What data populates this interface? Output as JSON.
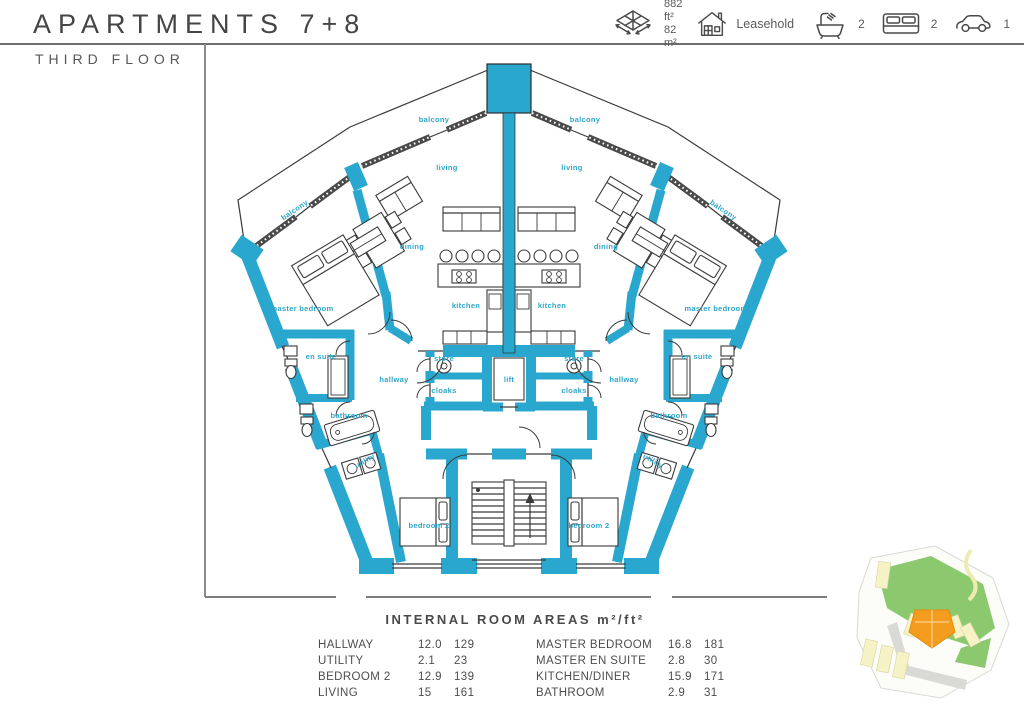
{
  "header": {
    "title": "APARTMENTS 7+8",
    "subtitle": "THIRD FLOOR",
    "stats": {
      "area_ft2": "882 ft²",
      "area_m2": "82 m²",
      "tenure": "Leasehold",
      "bathrooms": "2",
      "bedrooms": "2",
      "parking": "1",
      "icons": [
        "floor-area-icon",
        "house-icon",
        "bathtub-icon",
        "double-bed-icon",
        "car-icon"
      ]
    }
  },
  "plan": {
    "wall_color": "#2AA7CE",
    "label_color": "#2FA6C9",
    "room_labels": [
      {
        "text": "balcony",
        "x": 434,
        "y": 122,
        "rot": 0
      },
      {
        "text": "balcony",
        "x": 585,
        "y": 122,
        "rot": 0
      },
      {
        "text": "balcony",
        "x": 296,
        "y": 212,
        "rot": -34
      },
      {
        "text": "balcony",
        "x": 722,
        "y": 212,
        "rot": 34
      },
      {
        "text": "living",
        "x": 447,
        "y": 170,
        "rot": 0
      },
      {
        "text": "living",
        "x": 572,
        "y": 170,
        "rot": 0
      },
      {
        "text": "dining",
        "x": 412,
        "y": 249,
        "rot": 0
      },
      {
        "text": "dining",
        "x": 606,
        "y": 249,
        "rot": 0
      },
      {
        "text": "kitchen",
        "x": 466,
        "y": 308,
        "rot": 0
      },
      {
        "text": "kitchen",
        "x": 552,
        "y": 308,
        "rot": 0
      },
      {
        "text": "master bedroom",
        "x": 302,
        "y": 311,
        "rot": 0
      },
      {
        "text": "master bedroom",
        "x": 716,
        "y": 311,
        "rot": 0
      },
      {
        "text": "en suite",
        "x": 321,
        "y": 359,
        "rot": 0
      },
      {
        "text": "en suite",
        "x": 697,
        "y": 359,
        "rot": 0
      },
      {
        "text": "hallway",
        "x": 394,
        "y": 382,
        "rot": 0
      },
      {
        "text": "hallway",
        "x": 624,
        "y": 382,
        "rot": 0
      },
      {
        "text": "store",
        "x": 444,
        "y": 361,
        "rot": 0
      },
      {
        "text": "store",
        "x": 574,
        "y": 361,
        "rot": 0
      },
      {
        "text": "cloaks",
        "x": 444,
        "y": 393,
        "rot": 0
      },
      {
        "text": "cloaks",
        "x": 574,
        "y": 393,
        "rot": 0
      },
      {
        "text": "lift",
        "x": 509,
        "y": 382,
        "rot": 0
      },
      {
        "text": "bathroom",
        "x": 349,
        "y": 418,
        "rot": 0
      },
      {
        "text": "bathroom",
        "x": 669,
        "y": 418,
        "rot": 0
      },
      {
        "text": "utility",
        "x": 366,
        "y": 463,
        "rot": -30
      },
      {
        "text": "utility",
        "x": 652,
        "y": 463,
        "rot": 30
      },
      {
        "text": "bedroom 2",
        "x": 429,
        "y": 528,
        "rot": 0
      },
      {
        "text": "bedroom 2",
        "x": 589,
        "y": 528,
        "rot": 0
      }
    ]
  },
  "areas_table": {
    "title": "INTERNAL ROOM AREAS m²/ft²",
    "left": [
      {
        "name": "HALLWAY",
        "m2": "12.0",
        "ft2": "129"
      },
      {
        "name": "UTILITY",
        "m2": "2.1",
        "ft2": "23"
      },
      {
        "name": "BEDROOM 2",
        "m2": "12.9",
        "ft2": "139"
      },
      {
        "name": "LIVING",
        "m2": "15",
        "ft2": "161"
      }
    ],
    "right": [
      {
        "name": "MASTER BEDROOM",
        "m2": "16.8",
        "ft2": "181"
      },
      {
        "name": "MASTER EN SUITE",
        "m2": "2.8",
        "ft2": "30"
      },
      {
        "name": "KITCHEN/DINER",
        "m2": "15.9",
        "ft2": "171"
      },
      {
        "name": "BATHROOM",
        "m2": "2.9",
        "ft2": "31"
      }
    ]
  },
  "site_map": {
    "highlight_color": "#F49C1D",
    "green_color": "#8CC96E",
    "building_color": "#F5F2C6",
    "road_color": "#D9D9D6"
  }
}
